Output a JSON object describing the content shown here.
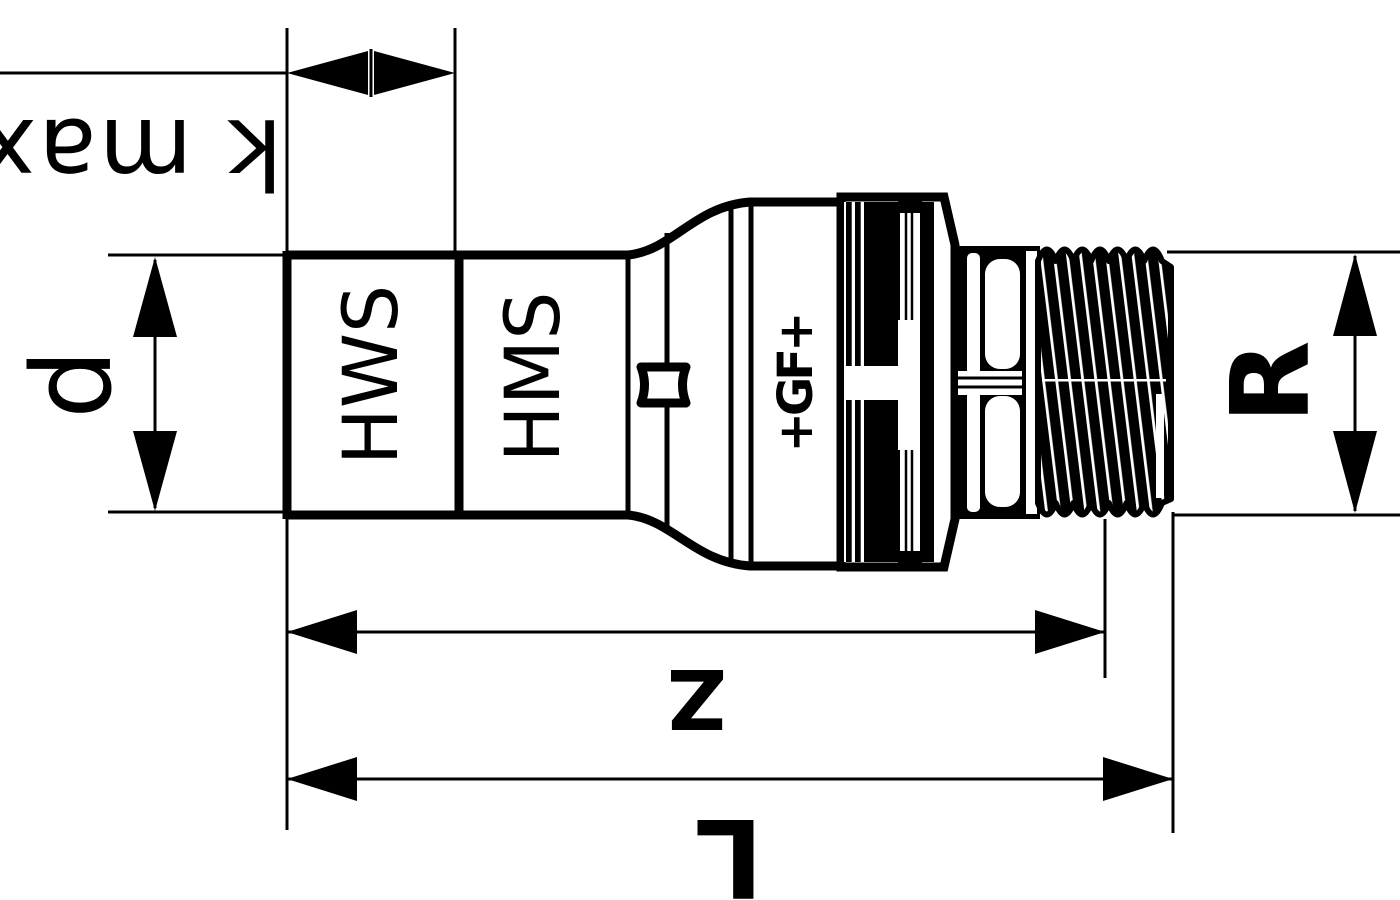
{
  "drawing": {
    "background_color": "#ffffff",
    "line_color": "#000000",
    "dimension_labels": {
      "kmax": "k max",
      "d": "d",
      "z": "Z",
      "l": "L",
      "r": "R"
    },
    "part_markings": {
      "left_socket": "HWS",
      "right_socket": "HMS",
      "logo": "+GF+"
    }
  }
}
